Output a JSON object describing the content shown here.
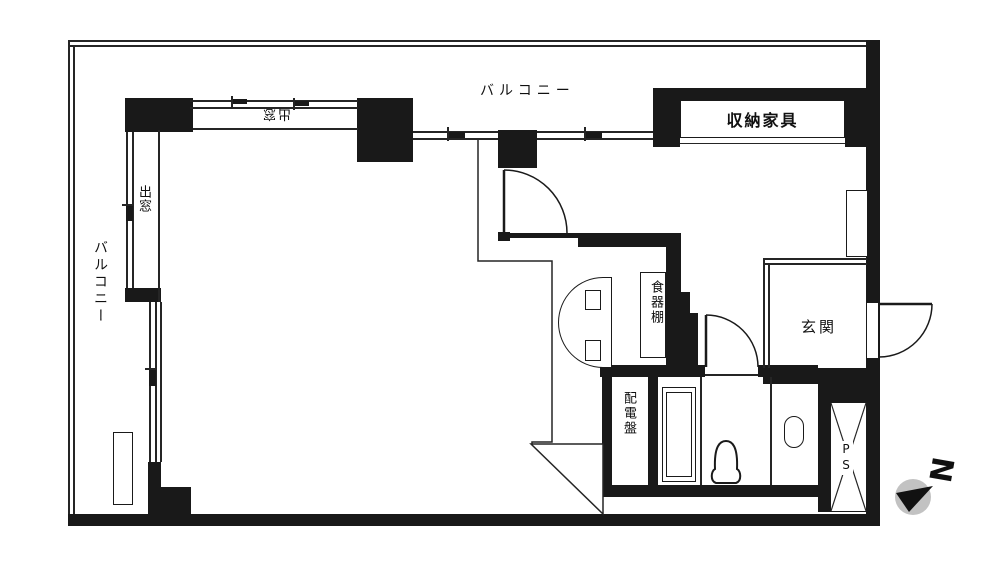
{
  "plan": {
    "type": "apartment-floor-plan",
    "labels": {
      "balcony_top": "バルコニー",
      "balcony_left": "バルコニー",
      "bay_window_top": "出窓",
      "bay_window_left": "出窓",
      "storage_furniture": "収納家具",
      "cupboard": "食器棚",
      "distribution_board": "配電盤",
      "entrance": "玄関",
      "pipe_space": "PS",
      "compass_north": "N"
    },
    "colors": {
      "wall": "#191919",
      "line": "#252525",
      "background": "#ffffff",
      "compass_circle": "#c2c2c2"
    }
  }
}
